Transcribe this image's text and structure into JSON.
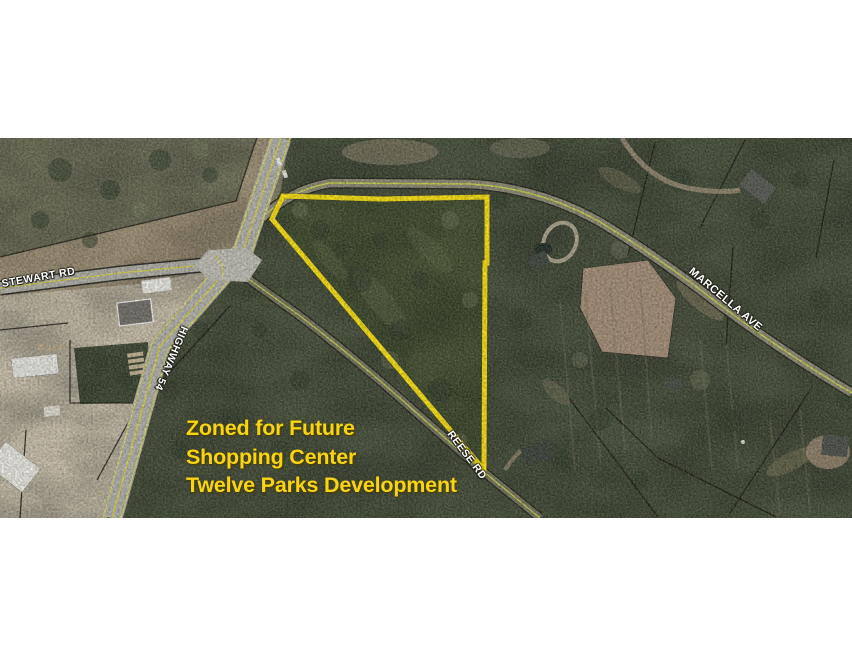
{
  "map": {
    "road_labels": {
      "stewart": "STEWART RD",
      "highway": "HIGHWAY 54",
      "marcella": "MARCELLA AVE",
      "reese": "REESE RD"
    },
    "caption": {
      "line1": "Zoned for Future",
      "line2": "Shopping Center",
      "line3": "Twelve Parks Development"
    },
    "colors": {
      "parcel_outline": "#ffe70d",
      "caption_text": "#f8d513",
      "road_label_text": "#ffffff",
      "forest_green": "#46503a",
      "field_tan": "#a89a7d",
      "asphalt_gray": "#b6b6b0",
      "centerline_yellow": "#ddd64a"
    }
  }
}
